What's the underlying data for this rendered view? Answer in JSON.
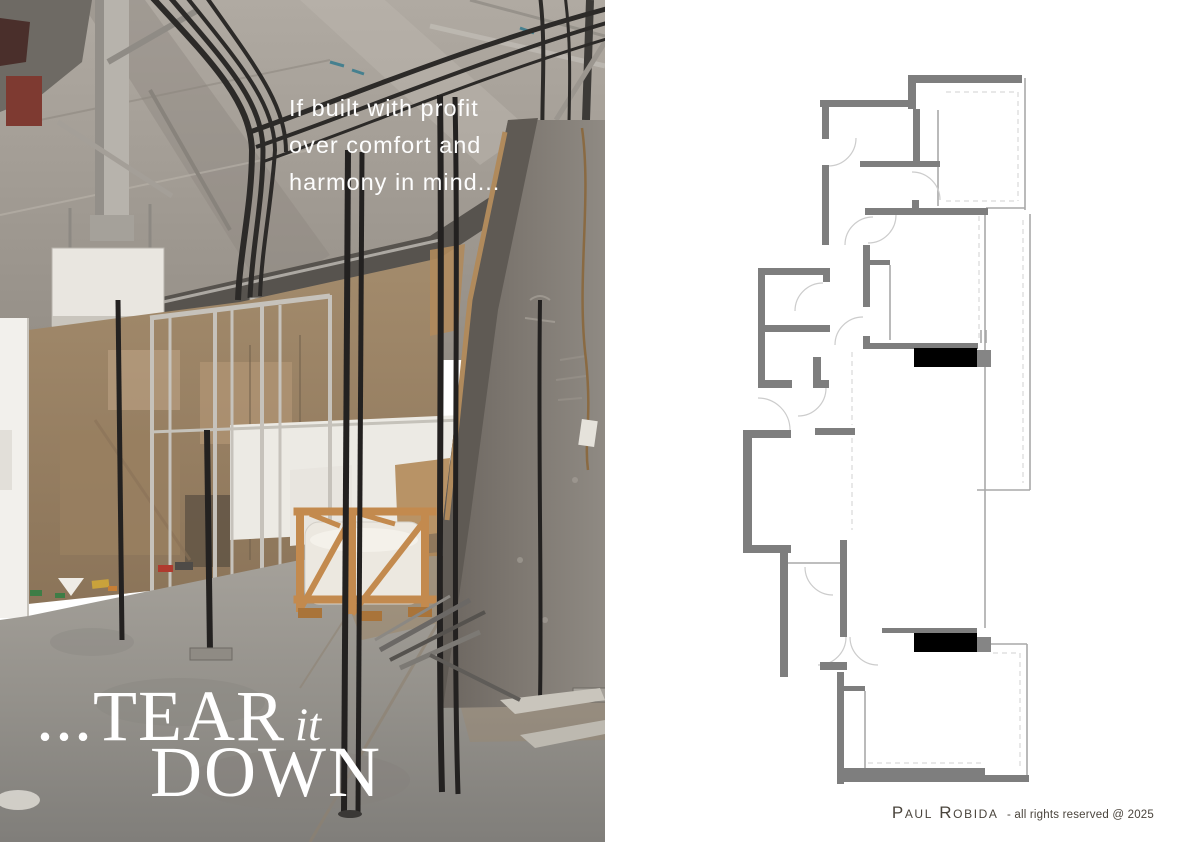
{
  "photo": {
    "quote_lines": [
      "If built with profit",
      "over comfort and",
      "harmony in mind..."
    ],
    "headline": {
      "dots": "...",
      "word1": "TEAR",
      "word2": "it",
      "word3": "DOWN"
    },
    "text_color": "#ffffff"
  },
  "footer": {
    "author": "Paul Robida",
    "rights": "- all rights reserved @ 2025",
    "color": "#4a443c"
  },
  "floorplan": {
    "wall_color": "#7e7e7e",
    "step_color": "#858585",
    "black_color": "#000000",
    "thin_color": "#a9a9a9",
    "dashed_color": "#d9d9d9",
    "arc_color": "#cccccc",
    "walls": [
      [
        168,
        5,
        114,
        8
      ],
      [
        168,
        5,
        8,
        34
      ],
      [
        173,
        39,
        7,
        53
      ],
      [
        120,
        91,
        80,
        6
      ],
      [
        172,
        130,
        7,
        15
      ],
      [
        125,
        138,
        123,
        7
      ],
      [
        80,
        30,
        92,
        7
      ],
      [
        82,
        30,
        7,
        39
      ],
      [
        82,
        95,
        7,
        80
      ],
      [
        18,
        198,
        72,
        7
      ],
      [
        18,
        198,
        7,
        64
      ],
      [
        18,
        255,
        72,
        7
      ],
      [
        83,
        198,
        7,
        14
      ],
      [
        18,
        262,
        7,
        56
      ],
      [
        18,
        310,
        34,
        8
      ],
      [
        73,
        287,
        8,
        31
      ],
      [
        73,
        310,
        16,
        8
      ],
      [
        123,
        175,
        7,
        62
      ],
      [
        123,
        266,
        7,
        7
      ],
      [
        123,
        273,
        115,
        6
      ],
      [
        130,
        190,
        20,
        5
      ],
      [
        3,
        360,
        48,
        8
      ],
      [
        3,
        360,
        9,
        123
      ],
      [
        3,
        475,
        48,
        8
      ],
      [
        40,
        483,
        8,
        124
      ],
      [
        75,
        358,
        40,
        7
      ],
      [
        100,
        470,
        7,
        97
      ],
      [
        80,
        592,
        27,
        8
      ],
      [
        97,
        602,
        7,
        112
      ],
      [
        103,
        616,
        22,
        5
      ],
      [
        142,
        558,
        95,
        5
      ],
      [
        97,
        698,
        148,
        14
      ],
      [
        245,
        705,
        44,
        7
      ]
    ],
    "black_rects": [
      [
        174,
        278,
        63,
        19
      ],
      [
        174,
        563,
        63,
        19
      ]
    ],
    "step_rects": [
      [
        237,
        280,
        14,
        17
      ],
      [
        237,
        567,
        14,
        15
      ]
    ],
    "thin_lines": [
      [
        198,
        40,
        198,
        136
      ],
      [
        285,
        8,
        285,
        140
      ],
      [
        246,
        138,
        285,
        138
      ],
      [
        245,
        144,
        245,
        558
      ],
      [
        290,
        144,
        290,
        420
      ],
      [
        237,
        420,
        290,
        420
      ],
      [
        150,
        195,
        150,
        270
      ],
      [
        48,
        493,
        105,
        493
      ],
      [
        125,
        621,
        125,
        698
      ],
      [
        250,
        574,
        287,
        574
      ],
      [
        287,
        574,
        287,
        712
      ],
      [
        241,
        260,
        241,
        273
      ],
      [
        246,
        260,
        246,
        273
      ]
    ],
    "dashed_lines": [
      [
        206,
        22,
        278,
        22
      ],
      [
        278,
        22,
        278,
        131
      ],
      [
        206,
        131,
        278,
        131
      ],
      [
        239,
        146,
        239,
        270
      ],
      [
        283,
        150,
        283,
        413
      ],
      [
        112,
        282,
        112,
        355
      ],
      [
        112,
        368,
        112,
        460
      ],
      [
        280,
        583,
        280,
        700
      ],
      [
        253,
        583,
        280,
        583
      ],
      [
        128,
        693,
        243,
        693
      ]
    ],
    "door_arcs": [
      "M172,102 A28,28 0 0 1 200,130",
      "M116,68 A28,28 0 0 1 88,96",
      "M105,175 A28,28 0 0 1 133,147",
      "M95,275 A28,28 0 0 1 123,247",
      "M55,241 A28,28 0 0 1 83,213",
      "M58,346 A28,28 0 0 0 86,318",
      "M18,328 A32,32 0 0 1 50,360",
      "M78,595 A28,28 0 0 0 106,567",
      "M110,567 A28,28 0 0 0 138,595",
      "M128,173 A28,28 0 0 0 156,145",
      "M65,497 A28,28 0 0 0 93,525"
    ]
  }
}
